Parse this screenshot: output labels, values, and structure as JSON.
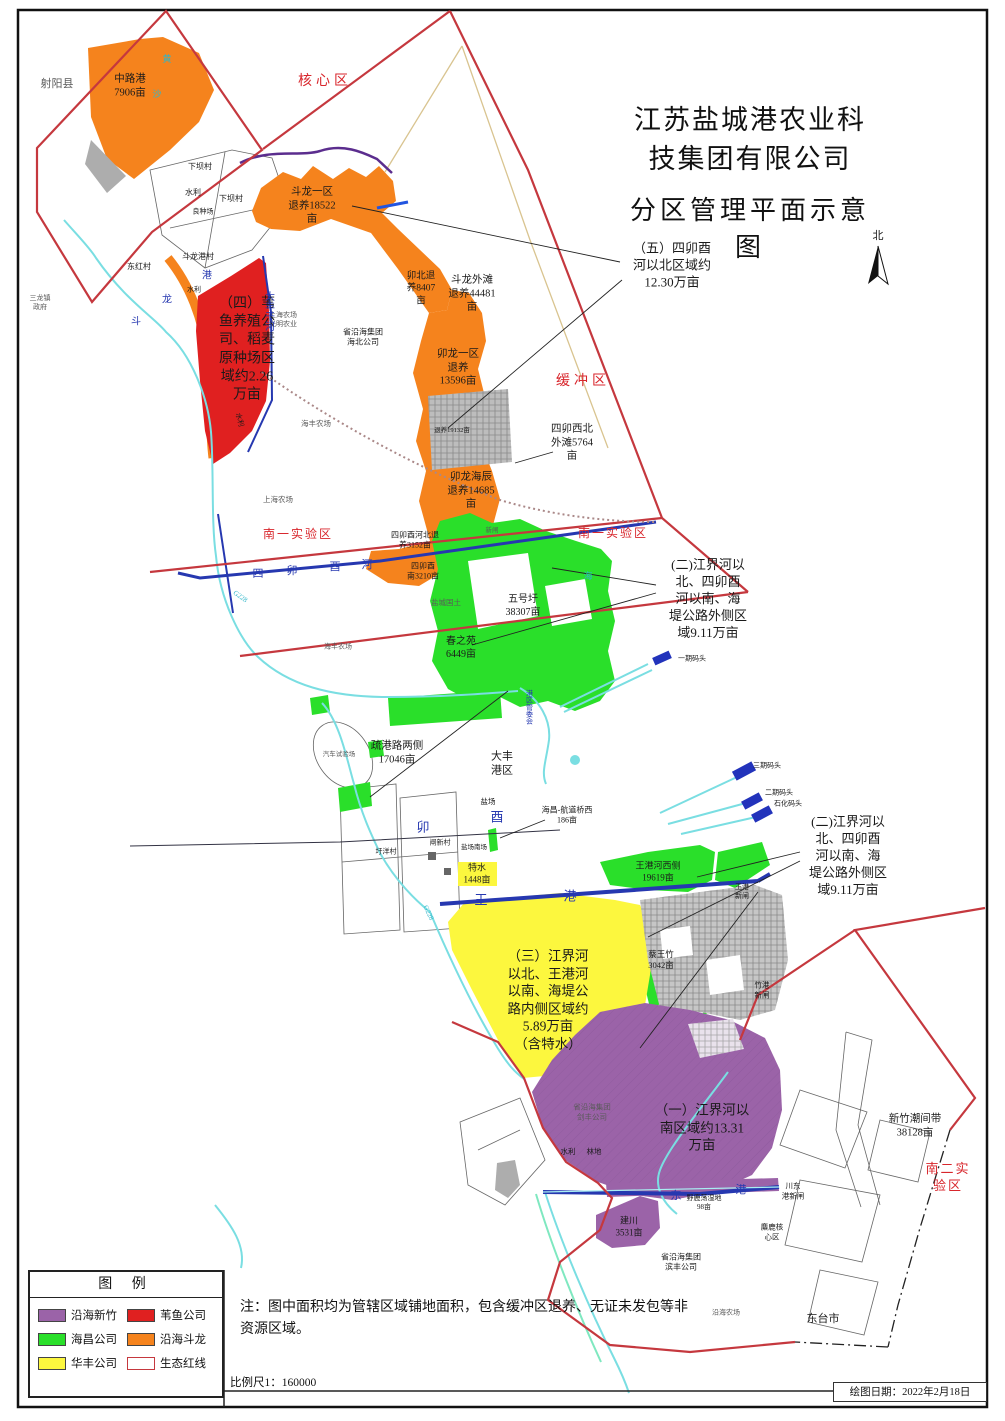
{
  "title": {
    "line1": "江苏盐城港农业科技集团有限公司",
    "line2": "分区管理平面示意图"
  },
  "colors": {
    "purple": "#9B63A8",
    "red": "#E02020",
    "green": "#2ADF2A",
    "orange": "#F5831D",
    "yellow": "#FCF73E",
    "redline": "#C5383E",
    "navy": "#2638B0",
    "cyan": "#7ADEE2",
    "gray": "#B5B5B5",
    "redtext": "#D8262C"
  },
  "legend": {
    "title": "图  例",
    "items": [
      {
        "label": "沿海新竹",
        "swatch": "purple"
      },
      {
        "label": "苇鱼公司",
        "swatch": "red"
      },
      {
        "label": "海昌公司",
        "swatch": "green"
      },
      {
        "label": "沿海斗龙",
        "swatch": "orange"
      },
      {
        "label": "华丰公司",
        "swatch": "yellow"
      },
      {
        "label": "生态红线",
        "swatch": "outline"
      }
    ]
  },
  "footer": {
    "note": "注：图中面积均为管辖区域铺地面积，包含缓冲区退养、无证未发包等非资源区域。",
    "scale": "比例尺1：160000",
    "date": "绘图日期：2022年2月18日"
  },
  "map_labels": [
    {
      "id": "north-label",
      "t": "北",
      "x": 878,
      "y": 236,
      "s": 11,
      "c": "black"
    },
    {
      "id": "county-sheyang",
      "t": "射阳县",
      "x": 57,
      "y": 84,
      "s": 11,
      "c": "gray"
    },
    {
      "id": "zone-zhonglugang",
      "t": "中路港\n7906亩",
      "x": 130,
      "y": 86,
      "s": 10.5,
      "c": "black"
    },
    {
      "id": "zone-hexinqu",
      "t": "核心区",
      "x": 325,
      "y": 82,
      "s": 14,
      "c": "red",
      "ls": 4
    },
    {
      "id": "village-xiabacun-1",
      "t": "下坝村",
      "x": 200,
      "y": 167,
      "s": 8,
      "c": "black"
    },
    {
      "id": "village-shuili-1",
      "t": "水利",
      "x": 193,
      "y": 193,
      "s": 8,
      "c": "black"
    },
    {
      "id": "village-xiabacun-2",
      "t": "下坝村",
      "x": 231,
      "y": 199,
      "s": 8,
      "c": "black"
    },
    {
      "id": "village-liangzhongchang",
      "t": "良种场",
      "x": 203,
      "y": 212,
      "s": 7,
      "c": "black"
    },
    {
      "id": "village-doulonggang",
      "t": "斗龙港村",
      "x": 198,
      "y": 257,
      "s": 8,
      "c": "black"
    },
    {
      "id": "village-donghongcun",
      "t": "东红村",
      "x": 139,
      "y": 267,
      "s": 8,
      "c": "black"
    },
    {
      "id": "village-sanlongzhen",
      "t": "三龙镇\n政府",
      "x": 40,
      "y": 303,
      "s": 7,
      "c": "gray"
    },
    {
      "id": "zone-doulongyiqu",
      "t": "斗龙一区\n退养18522\n亩",
      "x": 312,
      "y": 206,
      "s": 10.5,
      "c": "black"
    },
    {
      "id": "zone-maobei",
      "t": "卯北退\n养8407\n亩",
      "x": 421,
      "y": 289,
      "s": 9.5,
      "c": "black"
    },
    {
      "id": "zone-doulongwaitan",
      "t": "斗龙外滩\n退养44481\n亩",
      "x": 472,
      "y": 294,
      "s": 10.5,
      "c": "black"
    },
    {
      "id": "zone-huanchongqu",
      "t": "缓冲区",
      "x": 583,
      "y": 382,
      "s": 14,
      "c": "red",
      "ls": 4
    },
    {
      "id": "zone-maolongyiqu",
      "t": "卯龙一区\n退养\n13596亩",
      "x": 458,
      "y": 368,
      "s": 10.5,
      "c": "black"
    },
    {
      "id": "zone-simaoxibei",
      "t": "四卯西北\n外滩5764\n亩",
      "x": 572,
      "y": 443,
      "s": 10.5,
      "c": "black"
    },
    {
      "id": "zone-maolonghaichen",
      "t": "卯龙海辰\n退养14685\n亩",
      "x": 471,
      "y": 491,
      "s": 10.5,
      "c": "black"
    },
    {
      "id": "zone-tuiyang19132",
      "t": "退养19132亩",
      "x": 452,
      "y": 431,
      "s": 6.5,
      "c": "black"
    },
    {
      "id": "farm-shanghai-1",
      "t": "上海农场\n光明农业",
      "x": 283,
      "y": 320,
      "s": 7,
      "c": "gray"
    },
    {
      "id": "farm-haibei",
      "t": "省沿海集团\n海北公司",
      "x": 363,
      "y": 338,
      "s": 8,
      "c": "black"
    },
    {
      "id": "farm-haifeng-1",
      "t": "海丰农场",
      "x": 316,
      "y": 424,
      "s": 7.5,
      "c": "gray"
    },
    {
      "id": "farm-shanghai-2",
      "t": "上海农场",
      "x": 278,
      "y": 500,
      "s": 7.5,
      "c": "gray"
    },
    {
      "id": "annotation-five",
      "t": "（五）四卯酉\n河以北区域约\n12.30万亩",
      "x": 672,
      "y": 266,
      "s": 13,
      "c": "black",
      "w": 500
    },
    {
      "id": "annotation-four",
      "t": "（四）苇\n鱼养殖公\n司、稻麦\n原种场区\n域约2.26\n万亩",
      "x": 247,
      "y": 350,
      "s": 14,
      "c": "black",
      "w": 500
    },
    {
      "id": "river-dafengganhe",
      "t": "大丰干河",
      "x": 268,
      "y": 311,
      "s": 10,
      "c": "navy",
      "v": true
    },
    {
      "id": "river-gang-1",
      "t": "港",
      "x": 207,
      "y": 276,
      "s": 10,
      "c": "navy"
    },
    {
      "id": "river-long-1",
      "t": "龙",
      "x": 167,
      "y": 300,
      "s": 10,
      "c": "navy"
    },
    {
      "id": "river-dou-1",
      "t": "斗",
      "x": 136,
      "y": 322,
      "s": 10,
      "c": "navy"
    },
    {
      "id": "village-shuili-2",
      "t": "水利",
      "x": 194,
      "y": 290,
      "s": 7,
      "c": "black"
    },
    {
      "id": "village-shuili-4",
      "t": "水利",
      "x": 239,
      "y": 420,
      "s": 7,
      "c": "black",
      "r": 75
    },
    {
      "id": "zone-nanyi-left",
      "t": "南一实验区",
      "x": 298,
      "y": 535,
      "s": 12,
      "c": "red",
      "ls": 2
    },
    {
      "id": "zone-nanyi-right",
      "t": "南一实验区",
      "x": 613,
      "y": 534,
      "s": 12,
      "c": "red",
      "ls": 2
    },
    {
      "id": "zone-simaoyouhebei",
      "t": "四卯酉河北退\n养3152亩",
      "x": 415,
      "y": 541,
      "s": 8,
      "c": "black"
    },
    {
      "id": "gate-xinzha-1",
      "t": "新闸",
      "x": 492,
      "y": 531,
      "s": 6.5,
      "c": "gray"
    },
    {
      "id": "zone-simaoyounan",
      "t": "四卯酉\n南3210亩",
      "x": 423,
      "y": 572,
      "s": 8,
      "c": "black"
    },
    {
      "id": "river-si",
      "t": "四",
      "x": 258,
      "y": 574,
      "s": 11,
      "c": "navy"
    },
    {
      "id": "river-mao-1",
      "t": "卯",
      "x": 292,
      "y": 571,
      "s": 11,
      "c": "navy"
    },
    {
      "id": "river-you-1",
      "t": "酉",
      "x": 335,
      "y": 567,
      "s": 11,
      "c": "navy"
    },
    {
      "id": "river-he",
      "t": "河",
      "x": 367,
      "y": 565,
      "s": 11,
      "c": "navy"
    },
    {
      "id": "road-g228-1",
      "t": "G228",
      "x": 240,
      "y": 597,
      "s": 7,
      "c": "cyan",
      "r": 35
    },
    {
      "id": "farm-yanchengguotu",
      "t": "盐城国土",
      "x": 446,
      "y": 603,
      "s": 7.5,
      "c": "gray"
    },
    {
      "id": "zone-wuhaowei",
      "t": "五号圩\n38307亩",
      "x": 523,
      "y": 606,
      "s": 10,
      "c": "black"
    },
    {
      "id": "zone-chunzhiyuan",
      "t": "春之苑\n6449亩",
      "x": 461,
      "y": 648,
      "s": 10,
      "c": "black"
    },
    {
      "id": "farm-haifeng-2",
      "t": "海丰农场",
      "x": 338,
      "y": 647,
      "s": 7,
      "c": "gray"
    },
    {
      "id": "river-hai-1",
      "t": "海",
      "x": 588,
      "y": 577,
      "s": 9,
      "c": "cyan"
    },
    {
      "id": "annotation-two-a",
      "t": "(二)江界河以\n北、四卯酉\n河以南、海\n堤公路外侧区\n域9.11万亩",
      "x": 708,
      "y": 599,
      "s": 13,
      "c": "black",
      "w": 500
    },
    {
      "id": "dock-yiqi",
      "t": "一期码头",
      "x": 692,
      "y": 659,
      "s": 7,
      "c": "black"
    },
    {
      "id": "office-gangqu",
      "t": "港区管委会",
      "x": 529,
      "y": 707,
      "s": 7,
      "c": "navy",
      "v": true
    },
    {
      "id": "zone-shugonglu",
      "t": "疏港路两侧\n17046亩",
      "x": 397,
      "y": 753,
      "s": 10.5,
      "c": "black"
    },
    {
      "id": "site-qicheshiyanchang",
      "t": "汽车试验场",
      "x": 339,
      "y": 755,
      "s": 6.5,
      "c": "gray"
    },
    {
      "id": "zone-dafenggangqu",
      "t": "大丰\n港区",
      "x": 502,
      "y": 764,
      "s": 11,
      "c": "black"
    },
    {
      "id": "site-yanchang",
      "t": "盐场",
      "x": 488,
      "y": 802,
      "s": 7.5,
      "c": "black"
    },
    {
      "id": "zone-haichang-hangdao",
      "t": "海昌-航道桥西\n186亩",
      "x": 567,
      "y": 816,
      "s": 8,
      "c": "black"
    },
    {
      "id": "river-mao-2",
      "t": "卯",
      "x": 423,
      "y": 828,
      "s": 13,
      "c": "navy"
    },
    {
      "id": "river-you-2",
      "t": "酉",
      "x": 497,
      "y": 818,
      "s": 13,
      "c": "navy"
    },
    {
      "id": "village-weiyangcun",
      "t": "圩洋村",
      "x": 386,
      "y": 852,
      "s": 7,
      "c": "black"
    },
    {
      "id": "village-zhaxincun",
      "t": "闸新村",
      "x": 440,
      "y": 843,
      "s": 7,
      "c": "black"
    },
    {
      "id": "site-yanchangnanchang",
      "t": "盐场南场",
      "x": 474,
      "y": 848,
      "s": 6.5,
      "c": "black"
    },
    {
      "id": "dock-sanqi",
      "t": "三期码头",
      "x": 767,
      "y": 766,
      "s": 7,
      "c": "black"
    },
    {
      "id": "dock-erqi",
      "t": "二期码头",
      "x": 779,
      "y": 793,
      "s": 7,
      "c": "black"
    },
    {
      "id": "dock-shihua",
      "t": "石化码头",
      "x": 788,
      "y": 804,
      "s": 7,
      "c": "black"
    },
    {
      "id": "annotation-two-b",
      "t": "(二)江界河以\n北、四卯酉\n河以南、海\n堤公路外侧区\n域9.11万亩",
      "x": 848,
      "y": 856,
      "s": 13,
      "c": "black",
      "w": 500
    },
    {
      "id": "zone-wanggang-xice",
      "t": "王港河西侧\n19619亩",
      "x": 658,
      "y": 872,
      "s": 9,
      "c": "black"
    },
    {
      "id": "zone-teshui",
      "t": "特水\n1448亩",
      "x": 477,
      "y": 874,
      "s": 9,
      "c": "black"
    },
    {
      "id": "gate-wanggangxinzha",
      "t": "王港\n新闸",
      "x": 742,
      "y": 892,
      "s": 7,
      "c": "black"
    },
    {
      "id": "river-wang",
      "t": "王",
      "x": 481,
      "y": 901,
      "s": 13,
      "c": "navy"
    },
    {
      "id": "river-gang-2",
      "t": "港",
      "x": 570,
      "y": 897,
      "s": 13,
      "c": "navy"
    },
    {
      "id": "road-g228-2",
      "t": "G228",
      "x": 428,
      "y": 913,
      "s": 7,
      "c": "cyan",
      "r": 65
    },
    {
      "id": "zone-caiwangzhu",
      "t": "蔡王竹\n3042亩",
      "x": 661,
      "y": 960,
      "s": 8.5,
      "c": "black"
    },
    {
      "id": "annotation-three",
      "t": "（三）江界河\n以北、王港河\n以南、海堤公\n路内侧区域约\n5.89万亩\n（含特水）",
      "x": 548,
      "y": 1000,
      "s": 13.5,
      "c": "black",
      "w": 500
    },
    {
      "id": "gate-zhugangxinzha",
      "t": "竹港\n新闸",
      "x": 762,
      "y": 990,
      "s": 7.5,
      "c": "black"
    },
    {
      "id": "annotation-one",
      "t": "（一）江界河以\n南区域约13.31\n万亩",
      "x": 702,
      "y": 1128,
      "s": 13.5,
      "c": "black",
      "w": 500
    },
    {
      "id": "zone-xinzhu-chaojiandai",
      "t": "新竹潮间带\n38128亩",
      "x": 915,
      "y": 1126,
      "s": 10.5,
      "c": "black"
    },
    {
      "id": "zone-naner-shiyanqu",
      "t": "南二实验区",
      "x": 948,
      "y": 1178,
      "s": 13,
      "c": "red",
      "ls": 2
    },
    {
      "id": "farm-jianfeng",
      "t": "省沿海集团\n剑丰公司",
      "x": 592,
      "y": 1112,
      "s": 7.5,
      "c": "gray"
    },
    {
      "id": "site-shuili-3",
      "t": "水利",
      "x": 568,
      "y": 1152,
      "s": 7.5,
      "c": "black"
    },
    {
      "id": "site-lindi",
      "t": "林地",
      "x": 594,
      "y": 1152,
      "s": 7.5,
      "c": "black"
    },
    {
      "id": "river-dong",
      "t": "东",
      "x": 676,
      "y": 1196,
      "s": 11,
      "c": "navy"
    },
    {
      "id": "river-gang-3",
      "t": "港",
      "x": 741,
      "y": 1190,
      "s": 11,
      "c": "navy"
    },
    {
      "id": "gate-chuandonggang",
      "t": "川东\n港新闸",
      "x": 793,
      "y": 1191,
      "s": 7.5,
      "c": "black"
    },
    {
      "id": "site-yeludang",
      "t": "野鹿荡湿地\n98亩",
      "x": 704,
      "y": 1203,
      "s": 7,
      "c": "black"
    },
    {
      "id": "zone-jianchuan",
      "t": "建川\n3531亩",
      "x": 629,
      "y": 1227,
      "s": 9,
      "c": "black"
    },
    {
      "id": "site-milu",
      "t": "麋鹿核\n心区",
      "x": 772,
      "y": 1232,
      "s": 7.5,
      "c": "black"
    },
    {
      "id": "farm-binfeng",
      "t": "省沿海集团\n滨丰公司",
      "x": 681,
      "y": 1263,
      "s": 8,
      "c": "black"
    },
    {
      "id": "farm-yanhai",
      "t": "沿海农场",
      "x": 726,
      "y": 1313,
      "s": 7,
      "c": "gray"
    },
    {
      "id": "city-dongtai",
      "t": "东台市",
      "x": 823,
      "y": 1319,
      "s": 11,
      "c": "black"
    },
    {
      "id": "river-huang",
      "t": "黄",
      "x": 167,
      "y": 60,
      "s": 9,
      "c": "cyan"
    },
    {
      "id": "river-sha",
      "t": "沙",
      "x": 157,
      "y": 95,
      "s": 9,
      "c": "cyan"
    }
  ]
}
